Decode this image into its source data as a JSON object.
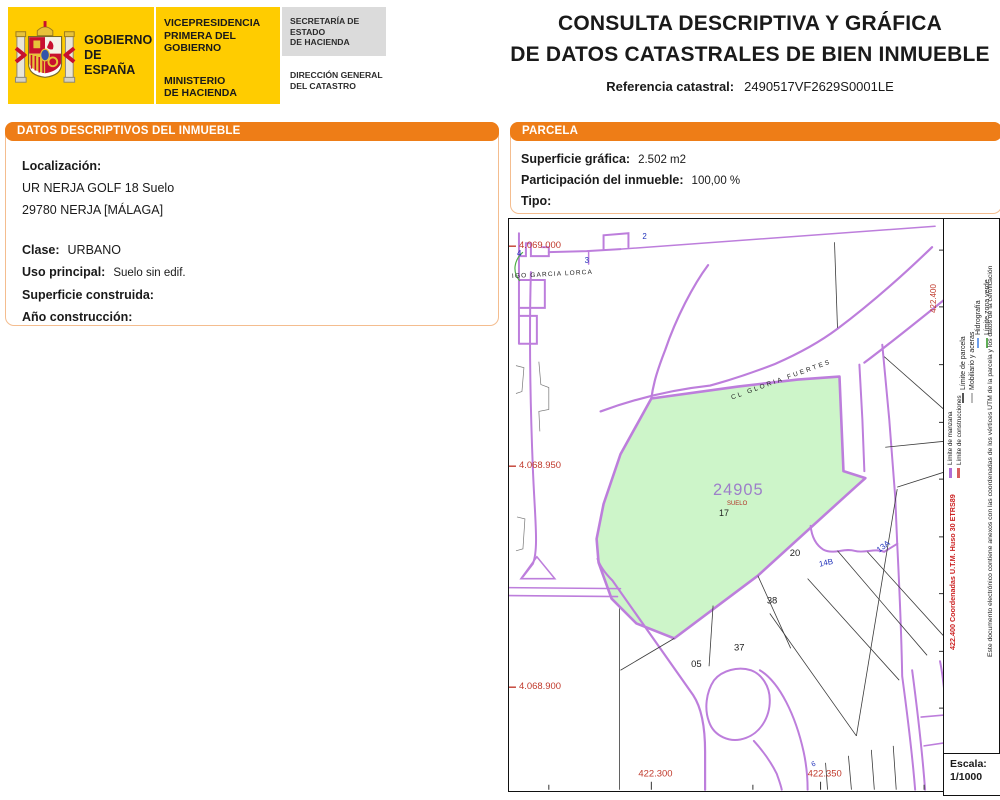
{
  "header": {
    "brand": {
      "gobierno": "GOBIERNO\nDE ESPAÑA",
      "vicepresidencia": "VICEPRESIDENCIA\nPRIMERA DEL GOBIERNO",
      "ministerio": "MINISTERIO\nDE HACIENDA",
      "secretaria": "SECRETARÍA DE ESTADO\nDE HACIENDA",
      "direccion": "DIRECCIÓN GENERAL\nDEL CATASTRO"
    },
    "title_line1": "CONSULTA DESCRIPTIVA Y GRÁFICA",
    "title_line2": "DE DATOS CATASTRALES DE BIEN INMUEBLE",
    "ref_label": "Referencia catastral:",
    "ref_value": "2490517VF2629S0001LE"
  },
  "left_panel": {
    "header": "DATOS DESCRIPTIVOS DEL INMUEBLE",
    "localizacion_label": "Localización:",
    "localizacion_line1": "UR NERJA GOLF 18 Suelo",
    "localizacion_line2": "29780 NERJA [MÁLAGA]",
    "clase_label": "Clase:",
    "clase_value": "URBANO",
    "uso_label": "Uso principal:",
    "uso_value": "Suelo sin edif.",
    "superficie_label": "Superficie construida:",
    "superficie_value": "",
    "anio_label": "Año construcción:",
    "anio_value": ""
  },
  "parcel_panel": {
    "header": "PARCELA",
    "superficie_label": "Superficie gráfica:",
    "superficie_value": "2.502 m2",
    "participacion_label": "Participación del inmueble:",
    "participacion_value": "100,00 %",
    "tipo_label": "Tipo:",
    "tipo_value": ""
  },
  "map": {
    "coord_y1": "4.069.000",
    "coord_y2": "4.068.950",
    "coord_y3": "4.068.900",
    "coord_x1": "422.300",
    "coord_x2": "422.350",
    "coord_x_rot": "422.400",
    "street1": "IGO GARCIA LORCA",
    "street2": "CL GLORIA FUERTES",
    "parcel_number": "24905",
    "parcel_use": "SUELO",
    "parcel_house": "17",
    "n20": "20",
    "n38": "38",
    "n37": "37",
    "n05": "05",
    "h2": "2",
    "h3": "3",
    "h4": "4",
    "h13a": "13A",
    "h14b": "14B",
    "h6": "6",
    "colors": {
      "parcel_fill": "#CDF5C9",
      "boundary_purple": "#BD7EDC",
      "coord_red": "#C0392B",
      "house_blue": "#2233BB",
      "parcel_label_violet": "#9D7FC9"
    }
  },
  "legend": {
    "items": [
      {
        "label": "Límite de manzana",
        "color": "#B06FD6"
      },
      {
        "label": "Límite de construcciones",
        "color": "#D95F5F"
      },
      {
        "label": "Límite de parcela",
        "color": "#555555"
      },
      {
        "label": "Mobiliario y aceras",
        "color": "#BBBBBB"
      },
      {
        "label": "Hidrografía",
        "color": "#6D9EEB"
      },
      {
        "label": "Límite zona verde",
        "color": "#5FAE57"
      }
    ],
    "coords_note": "422.400 Coordenadas U.T.M. Huso 30 ETRS89",
    "cert_note": "Este documento electrónico contiene anexos con las coordenadas de los vértices UTM de la parcela y los datos de la certificación",
    "escala_label": "Escala:",
    "escala_value": "1/1000"
  }
}
